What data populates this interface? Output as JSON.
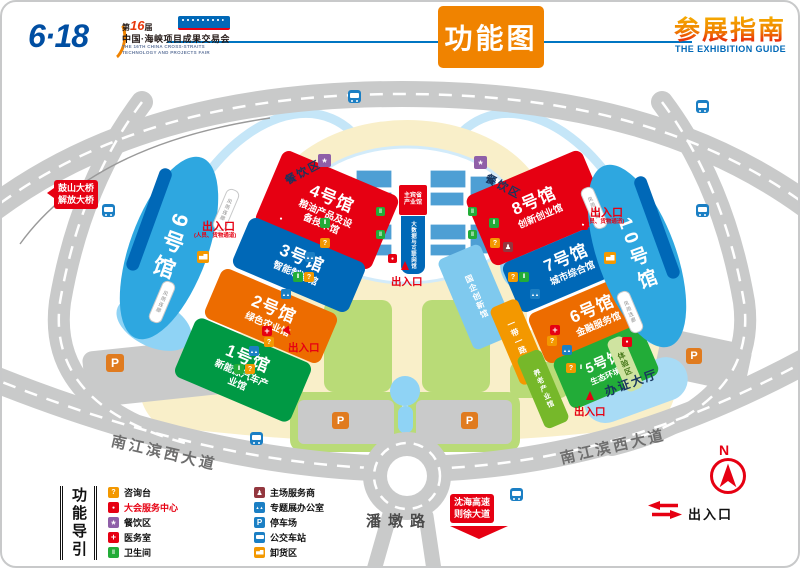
{
  "header": {
    "brand": "6·18",
    "edition_prefix": "第",
    "edition_number": "16",
    "edition_suffix": "届",
    "fair_name_cn": "中国·海峡项目成果交易会",
    "fair_name_en_line1": "THE 16TH CHINA CROSS-STRAITS",
    "fair_name_en_line2": "TECHNOLOGY AND PROJECTS FAIR",
    "page_title": "功能图",
    "guide_title_cn": "参展指南",
    "guide_title_en": "THE EXHIBITION GUIDE"
  },
  "map": {
    "halls": [
      {
        "name": "1号馆",
        "subtitle": "新能源汽车产业馆",
        "color": "#009944"
      },
      {
        "name": "2号馆",
        "subtitle": "绿色农业馆",
        "color": "#ed6c00"
      },
      {
        "name": "3号馆",
        "subtitle": "智能制造馆",
        "color": "#0068b7"
      },
      {
        "name": "4号馆",
        "subtitle": "粮油产品及设备技术馆",
        "color": "#e60012"
      },
      {
        "name": "5号馆",
        "subtitle": "生态环境馆",
        "color": "#22ac38"
      },
      {
        "name": "6号馆",
        "subtitle": "金融服务馆",
        "color": "#ed6c00"
      },
      {
        "name": "7号馆",
        "subtitle": "城市综合馆",
        "color": "#0068b7"
      },
      {
        "name": "8号馆",
        "subtitle": "创新创业馆",
        "color": "#e60012"
      },
      {
        "name": "9号馆",
        "color": "#2ea7e0"
      },
      {
        "name": "10号馆",
        "color": "#2ea7e0"
      }
    ],
    "special_areas": [
      {
        "name": "国企创新馆",
        "color": "#7fc9ee"
      },
      {
        "name": "一带一路馆",
        "color": "#f39800"
      },
      {
        "name": "养老产业馆",
        "color": "#76b82a"
      },
      {
        "name": "体验区",
        "color": "#cfe3a0"
      }
    ],
    "center": {
      "line1": "主宾省",
      "line2": "产业馆",
      "band": "大数据与互联网馆"
    },
    "entrance_label": "出入口",
    "entrance_note": "(人员、货物通道)",
    "dining_label": "餐饮区",
    "badge_hall_label": "办证大厅",
    "corridor_label": "风雨连廊",
    "roads": {
      "south_avenue": "南江滨西大道",
      "pandun": "潘墩路",
      "expressway_line1": "沈海高速",
      "expressway_line2": "则徐大道",
      "bridge_line1": "鼓山大桥",
      "bridge_line2": "解放大桥"
    },
    "compass_label": "N",
    "exit_legend_label": "出入口"
  },
  "legend": {
    "title": "功能导引",
    "col1": [
      {
        "label": "咨询台",
        "icon": "info-desk-icon",
        "color": "#f39800"
      },
      {
        "label": "大会服务中心",
        "icon": "service-center-icon",
        "color": "#e60012"
      },
      {
        "label": "餐饮区",
        "icon": "dining-icon",
        "color": "#8f5fa8"
      },
      {
        "label": "医务室",
        "icon": "medical-icon",
        "color": "#e60012"
      },
      {
        "label": "卫生间",
        "icon": "toilet-icon",
        "color": "#22ac38"
      }
    ],
    "col2": [
      {
        "label": "主场服务商",
        "icon": "organizer-icon",
        "color": "#93373f"
      },
      {
        "label": "专题展办公室",
        "icon": "office-icon",
        "color": "#1b7fc4"
      },
      {
        "label": "停车场",
        "icon": "parking-icon",
        "color": "#1b7fc4"
      },
      {
        "label": "公交车站",
        "icon": "bus-icon",
        "color": "#1b7fc4"
      },
      {
        "label": "卸货区",
        "icon": "unloading-icon",
        "color": "#f39800"
      }
    ]
  },
  "colors": {
    "accent_orange": "#f08300",
    "accent_red": "#e60012",
    "accent_blue": "#0068b7",
    "road_gray": "#c9caca",
    "ground_cream": "#f9efc9",
    "lawn_green": "#b9db77",
    "pond_blue": "#8fd3f5",
    "parking_icon_orange": "#e07b1f"
  }
}
